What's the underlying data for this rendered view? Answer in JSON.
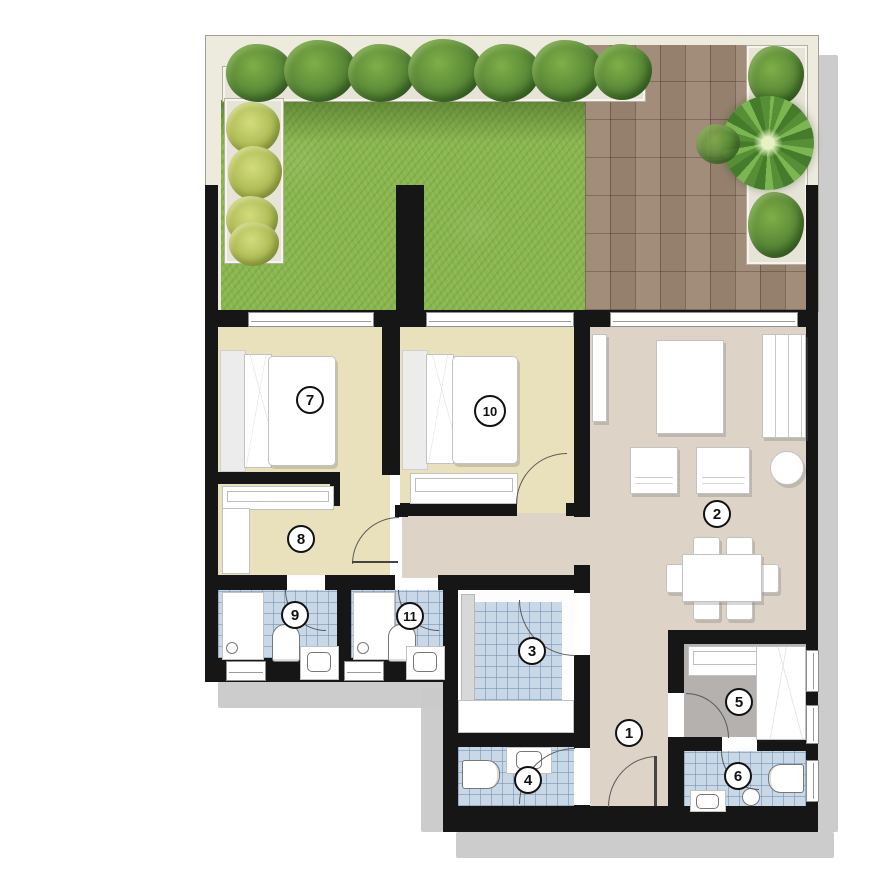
{
  "palette": {
    "wall": "#161616",
    "bedroom_floor": "#e9e1bb",
    "living_floor": "#ddd3c7",
    "tile_floor": "#c9d8e7",
    "grass": "#8ab64e",
    "hedge": "#4c7c31",
    "shrub_yellow": "#9fae45",
    "deck": "#9c8773",
    "maid_floor": "#b4b1ae",
    "terrace": "#edeade",
    "furniture_white": "#ffffff",
    "shadow": "#c9c9c9",
    "arc_line": "#5a5a5a"
  },
  "rooms": [
    {
      "number": "1"
    },
    {
      "number": "2"
    },
    {
      "number": "3"
    },
    {
      "number": "4"
    },
    {
      "number": "5"
    },
    {
      "number": "6"
    },
    {
      "number": "7"
    },
    {
      "number": "8"
    },
    {
      "number": "9"
    },
    {
      "number": "10"
    },
    {
      "number": "11"
    }
  ]
}
